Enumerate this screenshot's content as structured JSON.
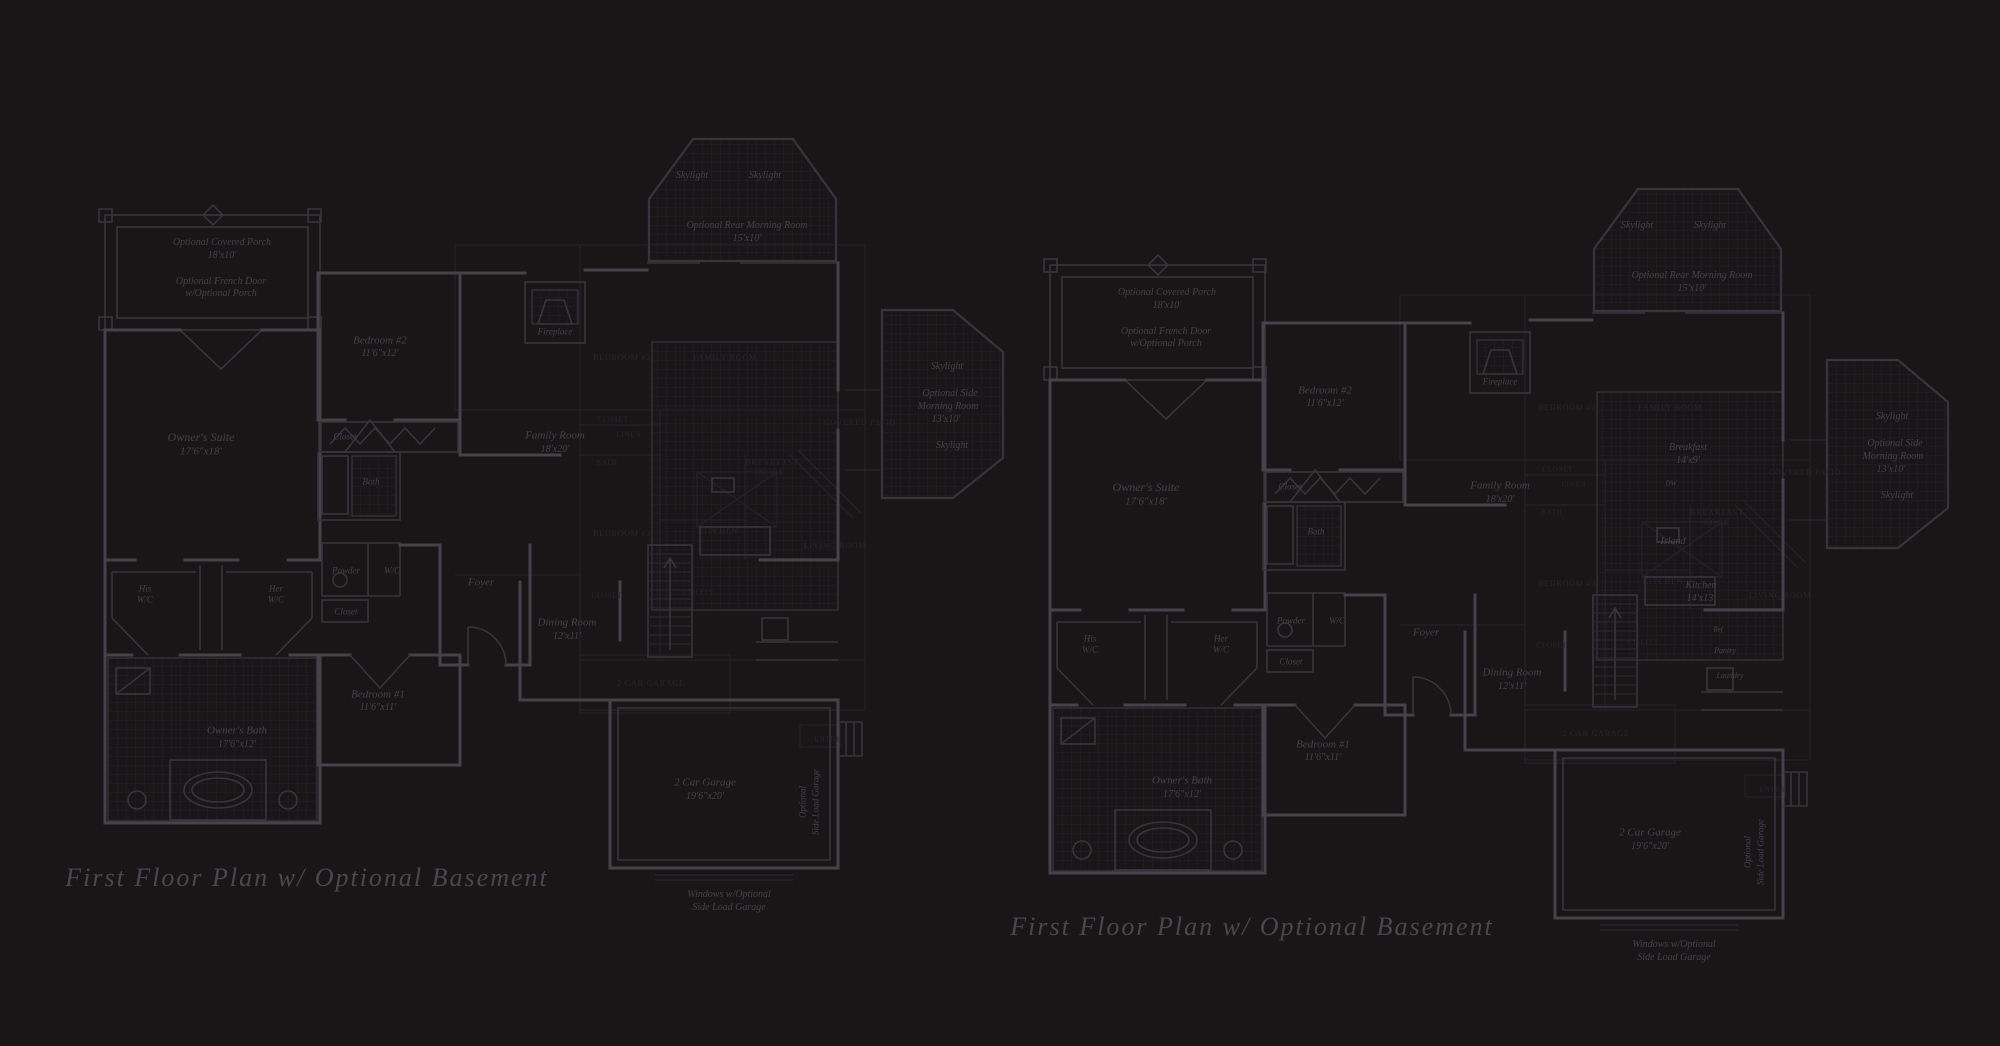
{
  "colors": {
    "background": "#191618",
    "walls": "#45424a",
    "walls_minor": "#37343c",
    "walls_faint": "#2c2931",
    "tile_grid": "#221f26",
    "faint_plan": "#242128",
    "text_main": "#45414a",
    "text_faint": "#2a272c",
    "title_text": "#4a4650"
  },
  "titles": {
    "left": "First Floor Plan  w/ Optional Basement",
    "right": "First Floor Plan  w/ Optional Basement"
  },
  "labels": [
    {
      "text": "First Floor Plan  w/ Optional Basement",
      "x": 307,
      "y": 878,
      "s": 26,
      "c": "t",
      "n": "plan-title-left"
    },
    {
      "text": "First Floor Plan  w/ Optional Basement",
      "x": 1252,
      "y": 927,
      "s": 26,
      "c": "t",
      "n": "plan-title-right"
    },
    {
      "text": "Optional Covered Porch",
      "x": 222,
      "y": 243,
      "s": 10,
      "c": "m",
      "n": "room-label-porch"
    },
    {
      "text": "18'x10'",
      "x": 222,
      "y": 256,
      "s": 10,
      "c": "m",
      "n": "dim-label"
    },
    {
      "text": "Optional French Door",
      "x": 221,
      "y": 282,
      "s": 10,
      "c": "m",
      "n": "note-label"
    },
    {
      "text": "w/Optional Porch",
      "x": 221,
      "y": 294,
      "s": 10,
      "c": "m",
      "n": "note-label"
    },
    {
      "text": "Owner's Suite",
      "x": 201,
      "y": 437,
      "s": 12,
      "c": "m",
      "n": "room-label-owners-suite"
    },
    {
      "text": "17'6\"x18'",
      "x": 201,
      "y": 452,
      "s": 11,
      "c": "m",
      "n": "dim-label"
    },
    {
      "text": "Bedroom #2",
      "x": 380,
      "y": 341,
      "s": 11,
      "c": "m",
      "n": "room-label-bedroom2"
    },
    {
      "text": "11'6\"x12'",
      "x": 380,
      "y": 354,
      "s": 10,
      "c": "m",
      "n": "dim-label"
    },
    {
      "text": "Closet",
      "x": 345,
      "y": 437,
      "s": 9,
      "c": "m",
      "n": "room-label-closet"
    },
    {
      "text": "Bath",
      "x": 371,
      "y": 482,
      "s": 9,
      "c": "m",
      "n": "room-label-bath"
    },
    {
      "text": "His",
      "x": 145,
      "y": 589,
      "s": 9,
      "c": "m",
      "n": "room-label-his-wc"
    },
    {
      "text": "W/C",
      "x": 145,
      "y": 600,
      "s": 9,
      "c": "m",
      "n": "room-label-his-wc"
    },
    {
      "text": "Her",
      "x": 276,
      "y": 589,
      "s": 9,
      "c": "m",
      "n": "room-label-her-wc"
    },
    {
      "text": "W/C",
      "x": 276,
      "y": 600,
      "s": 9,
      "c": "m",
      "n": "room-label-her-wc"
    },
    {
      "text": "Powder",
      "x": 346,
      "y": 571,
      "s": 9,
      "c": "m",
      "n": "room-label-powder"
    },
    {
      "text": "W/C",
      "x": 392,
      "y": 571,
      "s": 9,
      "c": "m",
      "n": "room-label-wc"
    },
    {
      "text": "Closet",
      "x": 346,
      "y": 612,
      "s": 9,
      "c": "m",
      "n": "room-label-closet"
    },
    {
      "text": "Foyer",
      "x": 481,
      "y": 583,
      "s": 11,
      "c": "m",
      "n": "room-label-foyer"
    },
    {
      "text": "Fireplace",
      "x": 555,
      "y": 332,
      "s": 9,
      "c": "m",
      "n": "room-label-fireplace"
    },
    {
      "text": "Family Room",
      "x": 555,
      "y": 436,
      "s": 11,
      "c": "m",
      "n": "room-label-family-room"
    },
    {
      "text": "18'x20'",
      "x": 555,
      "y": 450,
      "s": 10,
      "c": "m",
      "n": "dim-label"
    },
    {
      "text": "Dining Room",
      "x": 567,
      "y": 623,
      "s": 11,
      "c": "m",
      "n": "room-label-dining"
    },
    {
      "text": "12'x11'",
      "x": 567,
      "y": 637,
      "s": 10,
      "c": "m",
      "n": "dim-label"
    },
    {
      "text": "Bedroom #1",
      "x": 378,
      "y": 695,
      "s": 11,
      "c": "m",
      "n": "room-label-bedroom1"
    },
    {
      "text": "11'6\"x11'",
      "x": 378,
      "y": 708,
      "s": 10,
      "c": "m",
      "n": "dim-label"
    },
    {
      "text": "Owner's Bath",
      "x": 237,
      "y": 731,
      "s": 11,
      "c": "m",
      "n": "room-label-owners-bath"
    },
    {
      "text": "17'6\"x12'",
      "x": 237,
      "y": 745,
      "s": 10,
      "c": "m",
      "n": "dim-label"
    },
    {
      "text": "2 Car Garage",
      "x": 705,
      "y": 783,
      "s": 11,
      "c": "m",
      "n": "room-label-garage"
    },
    {
      "text": "19'6\"x20'",
      "x": 705,
      "y": 797,
      "s": 10,
      "c": "m",
      "n": "dim-label"
    },
    {
      "text": "Windows w/Optional",
      "x": 729,
      "y": 895,
      "s": 10,
      "c": "m",
      "n": "note-label"
    },
    {
      "text": "Side Load Garage",
      "x": 729,
      "y": 908,
      "s": 10,
      "c": "m",
      "n": "note-label"
    },
    {
      "text": "Optional",
      "x": 803,
      "y": 802,
      "s": 9,
      "c": "m",
      "r": -90,
      "n": "note-label"
    },
    {
      "text": "Side Load Garage",
      "x": 816,
      "y": 802,
      "s": 9,
      "c": "m",
      "r": -90,
      "n": "note-label"
    },
    {
      "text": "Skylight",
      "x": 692,
      "y": 176,
      "s": 10,
      "c": "m",
      "n": "label-skylight"
    },
    {
      "text": "Skylight",
      "x": 765,
      "y": 176,
      "s": 10,
      "c": "m",
      "n": "label-skylight"
    },
    {
      "text": "Optional Rear Morning Room",
      "x": 747,
      "y": 226,
      "s": 10,
      "c": "m",
      "n": "room-label-morning-room"
    },
    {
      "text": "15'x10'",
      "x": 747,
      "y": 239,
      "s": 10,
      "c": "m",
      "n": "dim-label"
    },
    {
      "text": "Skylight",
      "x": 947,
      "y": 367,
      "s": 10,
      "c": "m",
      "n": "label-skylight"
    },
    {
      "text": "Optional Side",
      "x": 950,
      "y": 394,
      "s": 10,
      "c": "m",
      "n": "room-label-side-morning"
    },
    {
      "text": "Morning Room",
      "x": 948,
      "y": 407,
      "s": 10,
      "c": "m",
      "n": "room-label-side-morning"
    },
    {
      "text": "13'x10'",
      "x": 946,
      "y": 420,
      "s": 10,
      "c": "m",
      "n": "dim-label"
    },
    {
      "text": "Skylight",
      "x": 952,
      "y": 446,
      "s": 10,
      "c": "m",
      "n": "label-skylight"
    },
    {
      "text": "Optional Covered Porch",
      "x": 1167,
      "y": 293,
      "s": 10,
      "c": "m",
      "n": "room-label-porch"
    },
    {
      "text": "18'x10'",
      "x": 1167,
      "y": 306,
      "s": 10,
      "c": "m",
      "n": "dim-label"
    },
    {
      "text": "Optional French Door",
      "x": 1166,
      "y": 332,
      "s": 10,
      "c": "m",
      "n": "note-label"
    },
    {
      "text": "w/Optional Porch",
      "x": 1166,
      "y": 344,
      "s": 10,
      "c": "m",
      "n": "note-label"
    },
    {
      "text": "Owner's Suite",
      "x": 1146,
      "y": 487,
      "s": 12,
      "c": "m",
      "n": "room-label-owners-suite"
    },
    {
      "text": "17'6\"x18'",
      "x": 1146,
      "y": 502,
      "s": 11,
      "c": "m",
      "n": "dim-label"
    },
    {
      "text": "Bedroom #2",
      "x": 1325,
      "y": 391,
      "s": 11,
      "c": "m",
      "n": "room-label-bedroom2"
    },
    {
      "text": "11'6\"x12'",
      "x": 1325,
      "y": 404,
      "s": 10,
      "c": "m",
      "n": "dim-label"
    },
    {
      "text": "Closet",
      "x": 1290,
      "y": 487,
      "s": 9,
      "c": "m",
      "n": "room-label-closet"
    },
    {
      "text": "Bath",
      "x": 1316,
      "y": 532,
      "s": 9,
      "c": "m",
      "n": "room-label-bath"
    },
    {
      "text": "His",
      "x": 1090,
      "y": 639,
      "s": 9,
      "c": "m",
      "n": "room-label-his-wc"
    },
    {
      "text": "W/C",
      "x": 1090,
      "y": 650,
      "s": 9,
      "c": "m",
      "n": "room-label-his-wc"
    },
    {
      "text": "Her",
      "x": 1221,
      "y": 639,
      "s": 9,
      "c": "m",
      "n": "room-label-her-wc"
    },
    {
      "text": "W/C",
      "x": 1221,
      "y": 650,
      "s": 9,
      "c": "m",
      "n": "room-label-her-wc"
    },
    {
      "text": "Powder",
      "x": 1291,
      "y": 621,
      "s": 9,
      "c": "m",
      "n": "room-label-powder"
    },
    {
      "text": "W/C",
      "x": 1337,
      "y": 621,
      "s": 9,
      "c": "m",
      "n": "room-label-wc"
    },
    {
      "text": "Closet",
      "x": 1291,
      "y": 662,
      "s": 9,
      "c": "m",
      "n": "room-label-closet"
    },
    {
      "text": "Foyer",
      "x": 1426,
      "y": 633,
      "s": 11,
      "c": "m",
      "n": "room-label-foyer"
    },
    {
      "text": "Fireplace",
      "x": 1500,
      "y": 382,
      "s": 9,
      "c": "m",
      "n": "room-label-fireplace"
    },
    {
      "text": "Family Room",
      "x": 1500,
      "y": 486,
      "s": 11,
      "c": "m",
      "n": "room-label-family-room"
    },
    {
      "text": "18'x20'",
      "x": 1500,
      "y": 500,
      "s": 10,
      "c": "m",
      "n": "dim-label"
    },
    {
      "text": "Breakfast",
      "x": 1688,
      "y": 448,
      "s": 10,
      "c": "m",
      "n": "room-label-breakfast"
    },
    {
      "text": "14'x9'",
      "x": 1688,
      "y": 461,
      "s": 10,
      "c": "m",
      "n": "dim-label"
    },
    {
      "text": "DW",
      "x": 1671,
      "y": 484,
      "s": 7,
      "c": "m",
      "n": "label-dishwasher"
    },
    {
      "text": "Island",
      "x": 1673,
      "y": 542,
      "s": 10,
      "c": "m",
      "n": "room-label-island"
    },
    {
      "text": "Kitchen",
      "x": 1701,
      "y": 586,
      "s": 10,
      "c": "m",
      "n": "room-label-kitchen"
    },
    {
      "text": "14'x13'",
      "x": 1701,
      "y": 599,
      "s": 10,
      "c": "m",
      "n": "dim-label"
    },
    {
      "text": "Ref",
      "x": 1718,
      "y": 630,
      "s": 7,
      "c": "m",
      "n": "label-refrigerator"
    },
    {
      "text": "Pantry",
      "x": 1725,
      "y": 651,
      "s": 8,
      "c": "m",
      "n": "room-label-pantry"
    },
    {
      "text": "Laundry",
      "x": 1730,
      "y": 676,
      "s": 8,
      "c": "m",
      "n": "room-label-laundry"
    },
    {
      "text": "Dining Room",
      "x": 1512,
      "y": 673,
      "s": 11,
      "c": "m",
      "n": "room-label-dining"
    },
    {
      "text": "12'x11'",
      "x": 1512,
      "y": 687,
      "s": 10,
      "c": "m",
      "n": "dim-label"
    },
    {
      "text": "Bedroom #1",
      "x": 1323,
      "y": 745,
      "s": 11,
      "c": "m",
      "n": "room-label-bedroom1"
    },
    {
      "text": "11'6\"x11'",
      "x": 1323,
      "y": 758,
      "s": 10,
      "c": "m",
      "n": "dim-label"
    },
    {
      "text": "Owner's Bath",
      "x": 1182,
      "y": 781,
      "s": 11,
      "c": "m",
      "n": "room-label-owners-bath"
    },
    {
      "text": "17'6\"x12'",
      "x": 1182,
      "y": 795,
      "s": 10,
      "c": "m",
      "n": "dim-label"
    },
    {
      "text": "2 Car Garage",
      "x": 1650,
      "y": 833,
      "s": 11,
      "c": "m",
      "n": "room-label-garage"
    },
    {
      "text": "19'6\"x20'",
      "x": 1650,
      "y": 847,
      "s": 10,
      "c": "m",
      "n": "dim-label"
    },
    {
      "text": "Windows w/Optional",
      "x": 1674,
      "y": 945,
      "s": 10,
      "c": "m",
      "n": "note-label"
    },
    {
      "text": "Side Load Garage",
      "x": 1674,
      "y": 958,
      "s": 10,
      "c": "m",
      "n": "note-label"
    },
    {
      "text": "Optional",
      "x": 1748,
      "y": 852,
      "s": 9,
      "c": "m",
      "r": -90,
      "n": "note-label"
    },
    {
      "text": "Side Load Garage",
      "x": 1761,
      "y": 852,
      "s": 9,
      "c": "m",
      "r": -90,
      "n": "note-label"
    },
    {
      "text": "Skylight",
      "x": 1637,
      "y": 226,
      "s": 10,
      "c": "m",
      "n": "label-skylight"
    },
    {
      "text": "Skylight",
      "x": 1710,
      "y": 226,
      "s": 10,
      "c": "m",
      "n": "label-skylight"
    },
    {
      "text": "Optional Rear Morning Room",
      "x": 1692,
      "y": 276,
      "s": 10,
      "c": "m",
      "n": "room-label-morning-room"
    },
    {
      "text": "15'x10'",
      "x": 1692,
      "y": 289,
      "s": 10,
      "c": "m",
      "n": "dim-label"
    },
    {
      "text": "Skylight",
      "x": 1892,
      "y": 417,
      "s": 10,
      "c": "m",
      "n": "label-skylight"
    },
    {
      "text": "Optional Side",
      "x": 1895,
      "y": 444,
      "s": 10,
      "c": "m",
      "n": "room-label-side-morning"
    },
    {
      "text": "Morning Room",
      "x": 1893,
      "y": 457,
      "s": 10,
      "c": "m",
      "n": "room-label-side-morning"
    },
    {
      "text": "13'x10'",
      "x": 1891,
      "y": 470,
      "s": 10,
      "c": "m",
      "n": "dim-label"
    },
    {
      "text": "Skylight",
      "x": 1897,
      "y": 496,
      "s": 10,
      "c": "m",
      "n": "label-skylight"
    },
    {
      "text": "BEDROOM #2",
      "x": 622,
      "y": 358,
      "s": 8,
      "c": "f",
      "n": "faint-label"
    },
    {
      "text": "FAMILY ROOM",
      "x": 725,
      "y": 358,
      "s": 8,
      "c": "f",
      "n": "faint-label"
    },
    {
      "text": "CLOSET",
      "x": 613,
      "y": 420,
      "s": 7,
      "c": "f",
      "n": "faint-label"
    },
    {
      "text": "LINEN",
      "x": 629,
      "y": 435,
      "s": 7,
      "c": "f",
      "n": "faint-label"
    },
    {
      "text": "COVERED PATIO",
      "x": 860,
      "y": 423,
      "s": 8,
      "c": "f",
      "n": "faint-label"
    },
    {
      "text": "BATH",
      "x": 607,
      "y": 463,
      "s": 7,
      "c": "f",
      "n": "faint-label"
    },
    {
      "text": "BREAKFAST",
      "x": 772,
      "y": 463,
      "s": 8,
      "c": "f",
      "n": "faint-label"
    },
    {
      "text": "NOOK",
      "x": 772,
      "y": 473,
      "s": 8,
      "c": "f",
      "n": "faint-label"
    },
    {
      "text": "KITCHEN",
      "x": 718,
      "y": 532,
      "s": 8,
      "c": "f",
      "n": "faint-label"
    },
    {
      "text": "BEDROOM #3",
      "x": 622,
      "y": 534,
      "s": 8,
      "c": "f",
      "n": "faint-label"
    },
    {
      "text": "LIVING ROOM",
      "x": 835,
      "y": 546,
      "s": 8,
      "c": "f",
      "n": "faint-label"
    },
    {
      "text": "CLOSET",
      "x": 607,
      "y": 596,
      "s": 7,
      "c": "f",
      "n": "faint-label"
    },
    {
      "text": "UTILITY",
      "x": 698,
      "y": 593,
      "s": 7,
      "c": "f",
      "n": "faint-label"
    },
    {
      "text": "2 CAR GARAGE",
      "x": 651,
      "y": 684,
      "s": 8,
      "c": "f",
      "n": "faint-label"
    },
    {
      "text": "ENTRY",
      "x": 828,
      "y": 740,
      "s": 7,
      "c": "f",
      "n": "faint-label"
    },
    {
      "text": "BEDROOM #2",
      "x": 1567,
      "y": 408,
      "s": 8,
      "c": "f",
      "n": "faint-label"
    },
    {
      "text": "FAMILY ROOM",
      "x": 1670,
      "y": 408,
      "s": 8,
      "c": "f",
      "n": "faint-label"
    },
    {
      "text": "CLOSET",
      "x": 1558,
      "y": 470,
      "s": 7,
      "c": "f",
      "n": "faint-label"
    },
    {
      "text": "LINEN",
      "x": 1574,
      "y": 485,
      "s": 7,
      "c": "f",
      "n": "faint-label"
    },
    {
      "text": "COVERED PATIO",
      "x": 1805,
      "y": 473,
      "s": 8,
      "c": "f",
      "n": "faint-label"
    },
    {
      "text": "BATH",
      "x": 1552,
      "y": 513,
      "s": 7,
      "c": "f",
      "n": "faint-label"
    },
    {
      "text": "BREAKFAST",
      "x": 1717,
      "y": 513,
      "s": 8,
      "c": "f",
      "n": "faint-label"
    },
    {
      "text": "NOOK",
      "x": 1717,
      "y": 523,
      "s": 8,
      "c": "f",
      "n": "faint-label"
    },
    {
      "text": "KITCHEN",
      "x": 1663,
      "y": 582,
      "s": 8,
      "c": "f",
      "n": "faint-label"
    },
    {
      "text": "BEDROOM #3",
      "x": 1567,
      "y": 584,
      "s": 8,
      "c": "f",
      "n": "faint-label"
    },
    {
      "text": "LIVING ROOM",
      "x": 1780,
      "y": 596,
      "s": 8,
      "c": "f",
      "n": "faint-label"
    },
    {
      "text": "CLOSET",
      "x": 1552,
      "y": 646,
      "s": 7,
      "c": "f",
      "n": "faint-label"
    },
    {
      "text": "UTILITY",
      "x": 1643,
      "y": 643,
      "s": 7,
      "c": "f",
      "n": "faint-label"
    },
    {
      "text": "2 CAR GARAGE",
      "x": 1596,
      "y": 734,
      "s": 8,
      "c": "f",
      "n": "faint-label"
    },
    {
      "text": "ENTRY",
      "x": 1773,
      "y": 790,
      "s": 7,
      "c": "f",
      "n": "faint-label"
    }
  ]
}
